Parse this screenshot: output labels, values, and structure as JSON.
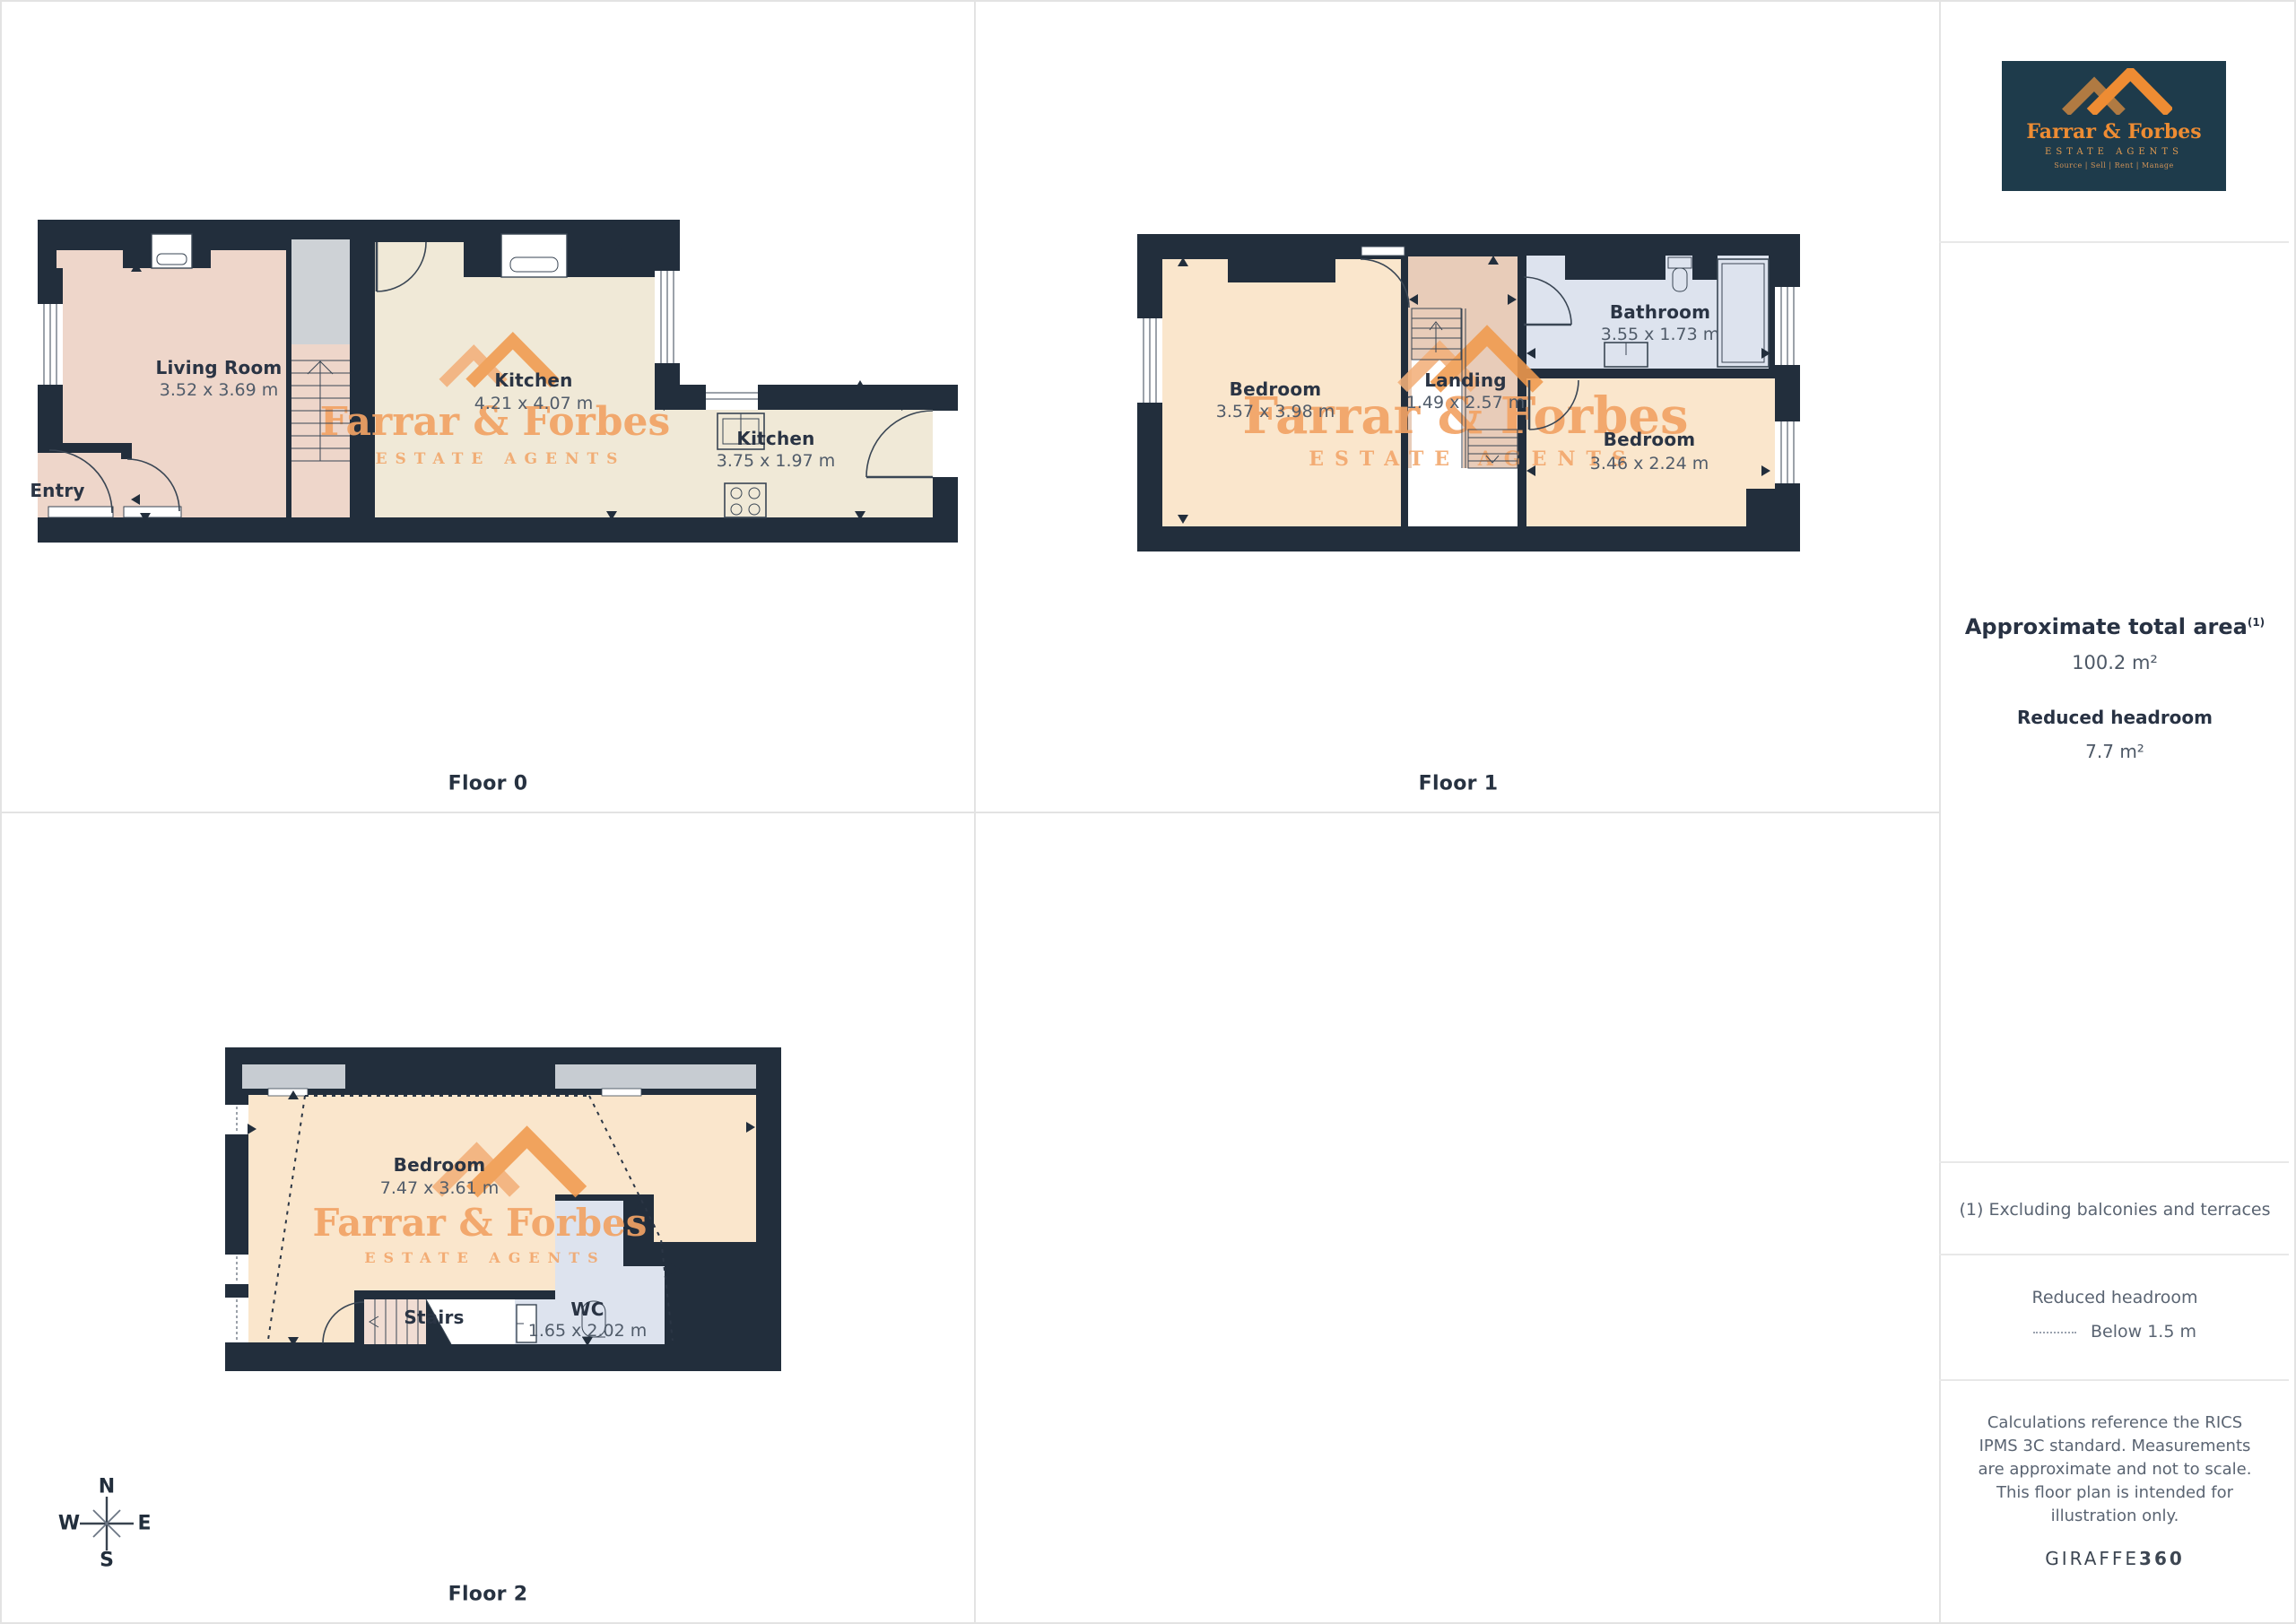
{
  "branding": {
    "logo_title": "Farrar & Forbes",
    "logo_subtitle": "ESTATE AGENTS",
    "logo_tagline": "Source | Sell | Rent | Manage",
    "watermark_title": "Farrar & Forbes",
    "watermark_subtitle": "ESTATE AGENTS",
    "logo_bg": "#1e3b4b",
    "accent_orange": "#ee8c33",
    "watermark_orange": "#f2a365"
  },
  "floors": [
    {
      "label": "Floor 0",
      "rooms": [
        {
          "name": "Living Room",
          "dims": "3.52 x 3.69 m"
        },
        {
          "name": "Kitchen",
          "dims": "4.21 x 4.07 m"
        },
        {
          "name": "Kitchen",
          "dims": "3.75 x 1.97 m"
        },
        {
          "name": "Entry",
          "dims": ""
        }
      ]
    },
    {
      "label": "Floor 1",
      "rooms": [
        {
          "name": "Bedroom",
          "dims": "3.57 x 3.98 m"
        },
        {
          "name": "Landing",
          "dims": "1.49 x 2.57 m"
        },
        {
          "name": "Bathroom",
          "dims": "3.55 x 1.73 m"
        },
        {
          "name": "Bedroom",
          "dims": "3.46 x 2.24 m"
        }
      ]
    },
    {
      "label": "Floor 2",
      "rooms": [
        {
          "name": "Bedroom",
          "dims": "7.47 x 3.61 m"
        },
        {
          "name": "Stairs",
          "dims": ""
        },
        {
          "name": "WC",
          "dims": "1.65 x 2.02 m"
        }
      ]
    }
  ],
  "compass": {
    "north": "N",
    "south": "S",
    "east": "E",
    "west": "W"
  },
  "sidebar": {
    "area_title": "Approximate total area",
    "area_superscript": "(1)",
    "area_value": "100.2 m²",
    "headroom_title": "Reduced headroom",
    "headroom_value": "7.7 m²",
    "footnote": "(1) Excluding balconies and terraces",
    "legend_title": "Reduced headroom",
    "legend_label": "Below 1.5 m",
    "disclaimer": "Calculations reference the RICS IPMS 3C standard. Measurements are approximate and not to scale. This floor plan is intended for illustration only.",
    "brand_name": "GIRAFFE",
    "brand_suffix": "360"
  },
  "colors": {
    "wall": "#222e3c",
    "living_room": "#eed6ca",
    "kitchen": "#f0e9d7",
    "bedroom": "#fae6cc",
    "landing": "#e8ccb9",
    "bathroom": "#dde3ee",
    "stairs_gray": "#ced2d6",
    "dormer_gray": "#c7ccd2",
    "text_navy": "#2a3444",
    "text_gray": "#515c6a"
  }
}
